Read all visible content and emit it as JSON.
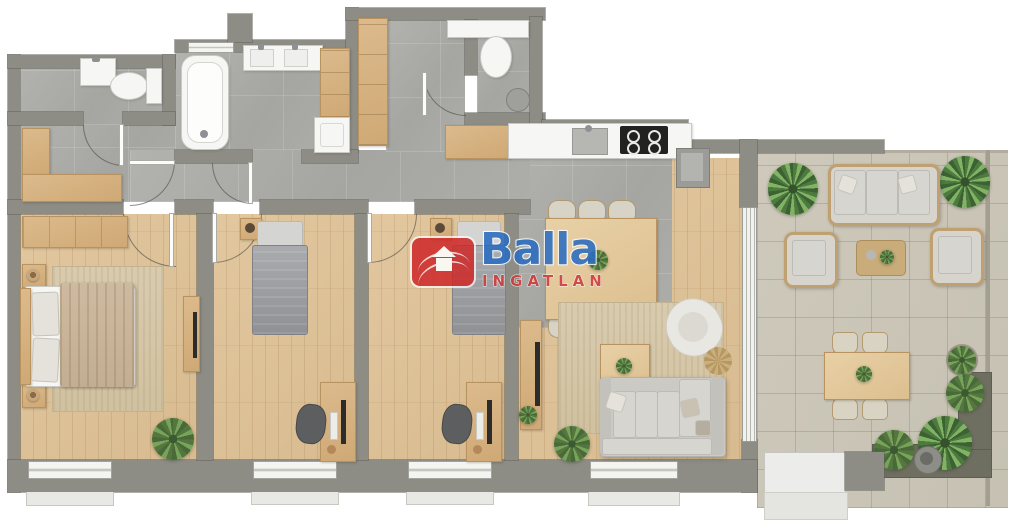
{
  "watermark": {
    "brand": "Balla",
    "subtitle": "INGATLAN",
    "brand_color": "#2a6cc0",
    "subtitle_color": "#ce3a3a",
    "icon": "house-icon",
    "icon_bg": "#cf2b2b"
  },
  "palette": {
    "wall": "#8d8d85",
    "wood_floor": "#ddc29a",
    "tile_floor": "#ababa7",
    "terrace_tile": "#ccc7b8",
    "furniture_wood": "#d7b585",
    "fixture_white": "#f6f6f4",
    "bed_gray": "#9b9da0",
    "sofa": "#cbcac4",
    "rug": "#d6c7a9",
    "plant": "#618549",
    "wicker": "#bfa071"
  },
  "rooms": [
    {
      "name": "entry-hall"
    },
    {
      "name": "wc-1"
    },
    {
      "name": "bathroom"
    },
    {
      "name": "wc-2"
    },
    {
      "name": "kitchen"
    },
    {
      "name": "living-room"
    },
    {
      "name": "master-bedroom"
    },
    {
      "name": "bedroom-1"
    },
    {
      "name": "bedroom-2"
    },
    {
      "name": "terrace"
    }
  ]
}
